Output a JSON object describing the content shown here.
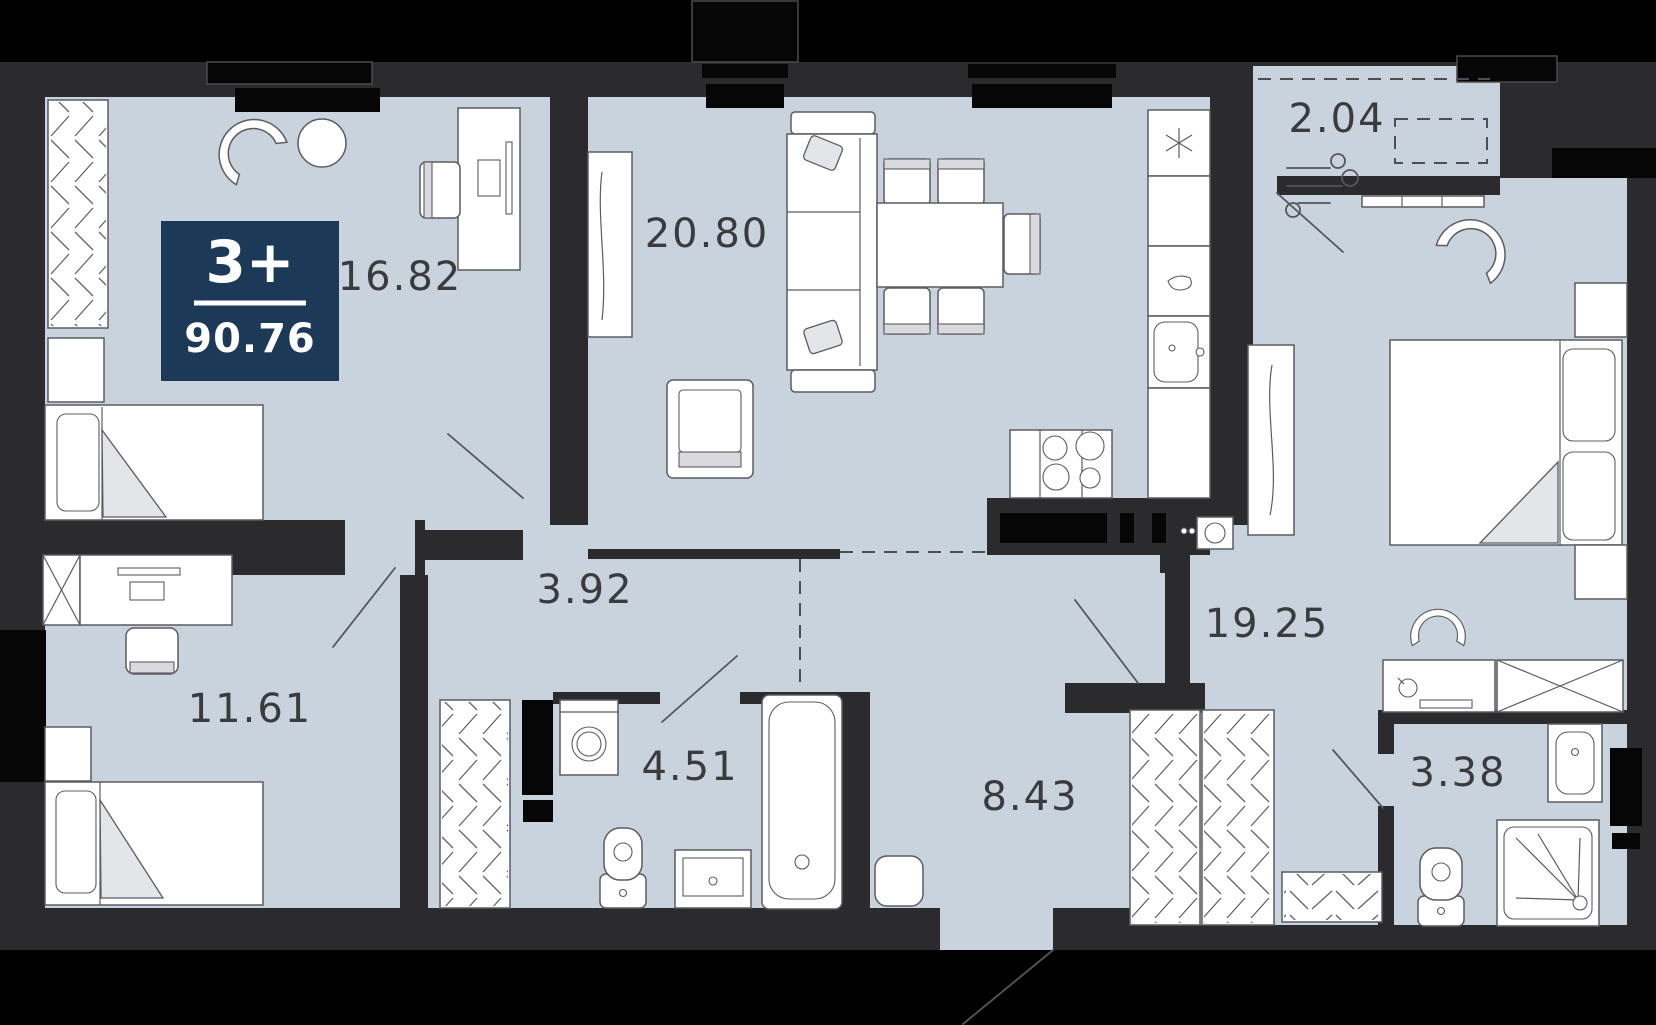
{
  "title": "Apartment floor plan 3+ rooms, 90.76 m2",
  "badge": {
    "rooms": "3+",
    "total_area": "90.76"
  },
  "rooms": [
    {
      "id": "bedroom-top-left",
      "area": "16.82"
    },
    {
      "id": "living-kitchen",
      "area": "20.80"
    },
    {
      "id": "balcony",
      "area": "2.04"
    },
    {
      "id": "bedroom-right",
      "area": "19.25"
    },
    {
      "id": "bedroom-bottom",
      "area": "11.61"
    },
    {
      "id": "corridor",
      "area": "3.92"
    },
    {
      "id": "bathroom",
      "area": "4.51"
    },
    {
      "id": "hallway",
      "area": "8.43"
    },
    {
      "id": "shower-room",
      "area": "3.38"
    }
  ],
  "colors": {
    "background": "#000000",
    "wall": "#2b2b2d",
    "floor": "#c9d3de",
    "badge_bg": "#1c3a57",
    "badge_text": "#ffffff",
    "area_label": "#3b3b3d",
    "furniture_stroke": "#5b5c60"
  },
  "icons": {
    "fridge-icon": "asterisk",
    "wind-icon": "breeze-curves",
    "kettle-icon": "teardrop",
    "door-swing-icon": "diagonal-leaf-line",
    "wardrobe-icon": "zigzag-hatch",
    "window-icon": "black-bar"
  }
}
